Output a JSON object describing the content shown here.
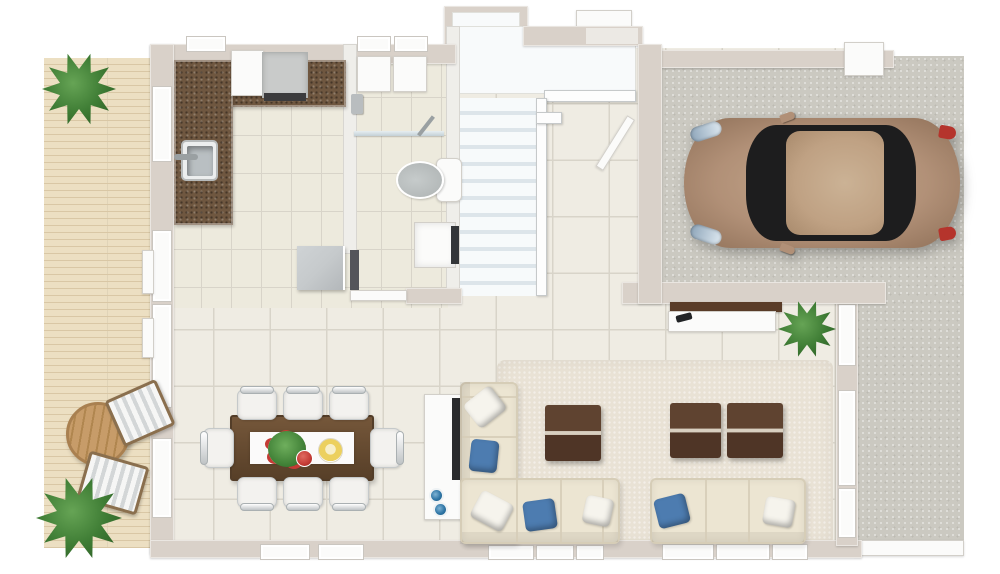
{
  "scene": {
    "type": "floor-plan-3d-top-view",
    "floor": "ground-floor",
    "rooms": [
      {
        "id": "deck-patio",
        "furniture": [
          "round-wood-table",
          "lounge-chair",
          "lounge-chair",
          "potted-plant",
          "potted-plant"
        ]
      },
      {
        "id": "kitchen",
        "furniture": [
          "l-shaped-granite-counter",
          "sink-with-faucet",
          "range-cooktop",
          "built-in-appliance",
          "kitchen-island",
          "blue-bowl",
          "blue-bowl"
        ]
      },
      {
        "id": "bathroom",
        "furniture": [
          "wall-cabinet",
          "wall-cabinet",
          "shower-glass-screen",
          "shower-head",
          "toilet",
          "wash-basin"
        ]
      },
      {
        "id": "staircase",
        "details": {
          "treads": 11,
          "landing": true,
          "railing": true
        }
      },
      {
        "id": "entry-hall",
        "furniture": [
          "open-door"
        ]
      },
      {
        "id": "garage",
        "furniture": [
          "car"
        ]
      },
      {
        "id": "dining-area",
        "furniture": [
          "dining-table",
          "table-runner",
          "flower-centerpiece",
          "fruit-plate",
          "dining-chair",
          "dining-chair",
          "dining-chair",
          "dining-chair",
          "dining-chair",
          "dining-chair",
          "dining-chair",
          "dining-chair"
        ]
      },
      {
        "id": "living-area",
        "furniture": [
          "l-shaped-sectional-sofa",
          "three-seat-sofa",
          "coffee-table",
          "coffee-table",
          "coffee-table",
          "area-rug",
          "tv-console",
          "tv",
          "remote-control",
          "potted-plant"
        ]
      },
      {
        "id": "driveway",
        "furniture": []
      }
    ],
    "counts": {
      "dining_chairs": 8,
      "sofas": 2,
      "coffee_tables": 3,
      "potted_plants": 3,
      "stair_treads": 11,
      "sofa_pillows": 7
    },
    "car": {
      "body_color": "tan",
      "facing": "left",
      "headlights": 2,
      "taillights": 2,
      "mirrors": 2
    }
  },
  "colors": {
    "page_bg": "#ffffff",
    "wall": "#d9d1c9",
    "wall_white": "#efeeea",
    "wall_gap": "#ece9e4",
    "win_face": "#fbfbfa",
    "win_border": "#cac6c0",
    "tile": "#efece3",
    "tile_sm": "#edeadd",
    "grout": "#d8d4c9",
    "deck": "#ecdfc2",
    "deck_line": "#d9c7a5",
    "concrete": "#cbc9c1",
    "rug": "#e9e2d5",
    "stair_white": "#f8fafb",
    "stair_tread": "#dde5ea",
    "rail_border": "#c6c9ca",
    "counter": "#6f5740",
    "steel": "#b9bfc2",
    "appliance": "#c9cbca",
    "vent": "#3c3c3e",
    "sofa": "#ece5d2",
    "sofa_edge": "#d6cdb7",
    "pillow_blue": "#4d7cb0",
    "pillow_white": "#f6f4ed",
    "wood_table": "#6b4e33",
    "wood_table_dark": "#573f28",
    "coffee_dark": "#4f3526",
    "coffee_light": "#5f4330",
    "coffee_seam": "#d8cfc0",
    "runner": "#fbfafa",
    "plate_yellow": "#ecd05e",
    "flower_red": "#c43b35",
    "leaf_green": "#3f7d35",
    "leaf_dark": "#2d5f26",
    "patio_wood": "#c79c69",
    "patio_wood_dark": "#b0864f",
    "lounge_frame": "#8a6f4e",
    "lounge_stripe": "#d3d6d7",
    "car_body": "#b19077",
    "car_glass": "#1d1d1e",
    "car_roof": "#bfa183",
    "car_red": "#b5342c",
    "toilet_gray": "#b5baba",
    "bowl_blue": "#2f76a6",
    "tv_wood": "#5a3c28",
    "door_panel": "#c6cacc",
    "glass": "#c3d0d6",
    "dark_strip": "#54555a"
  }
}
